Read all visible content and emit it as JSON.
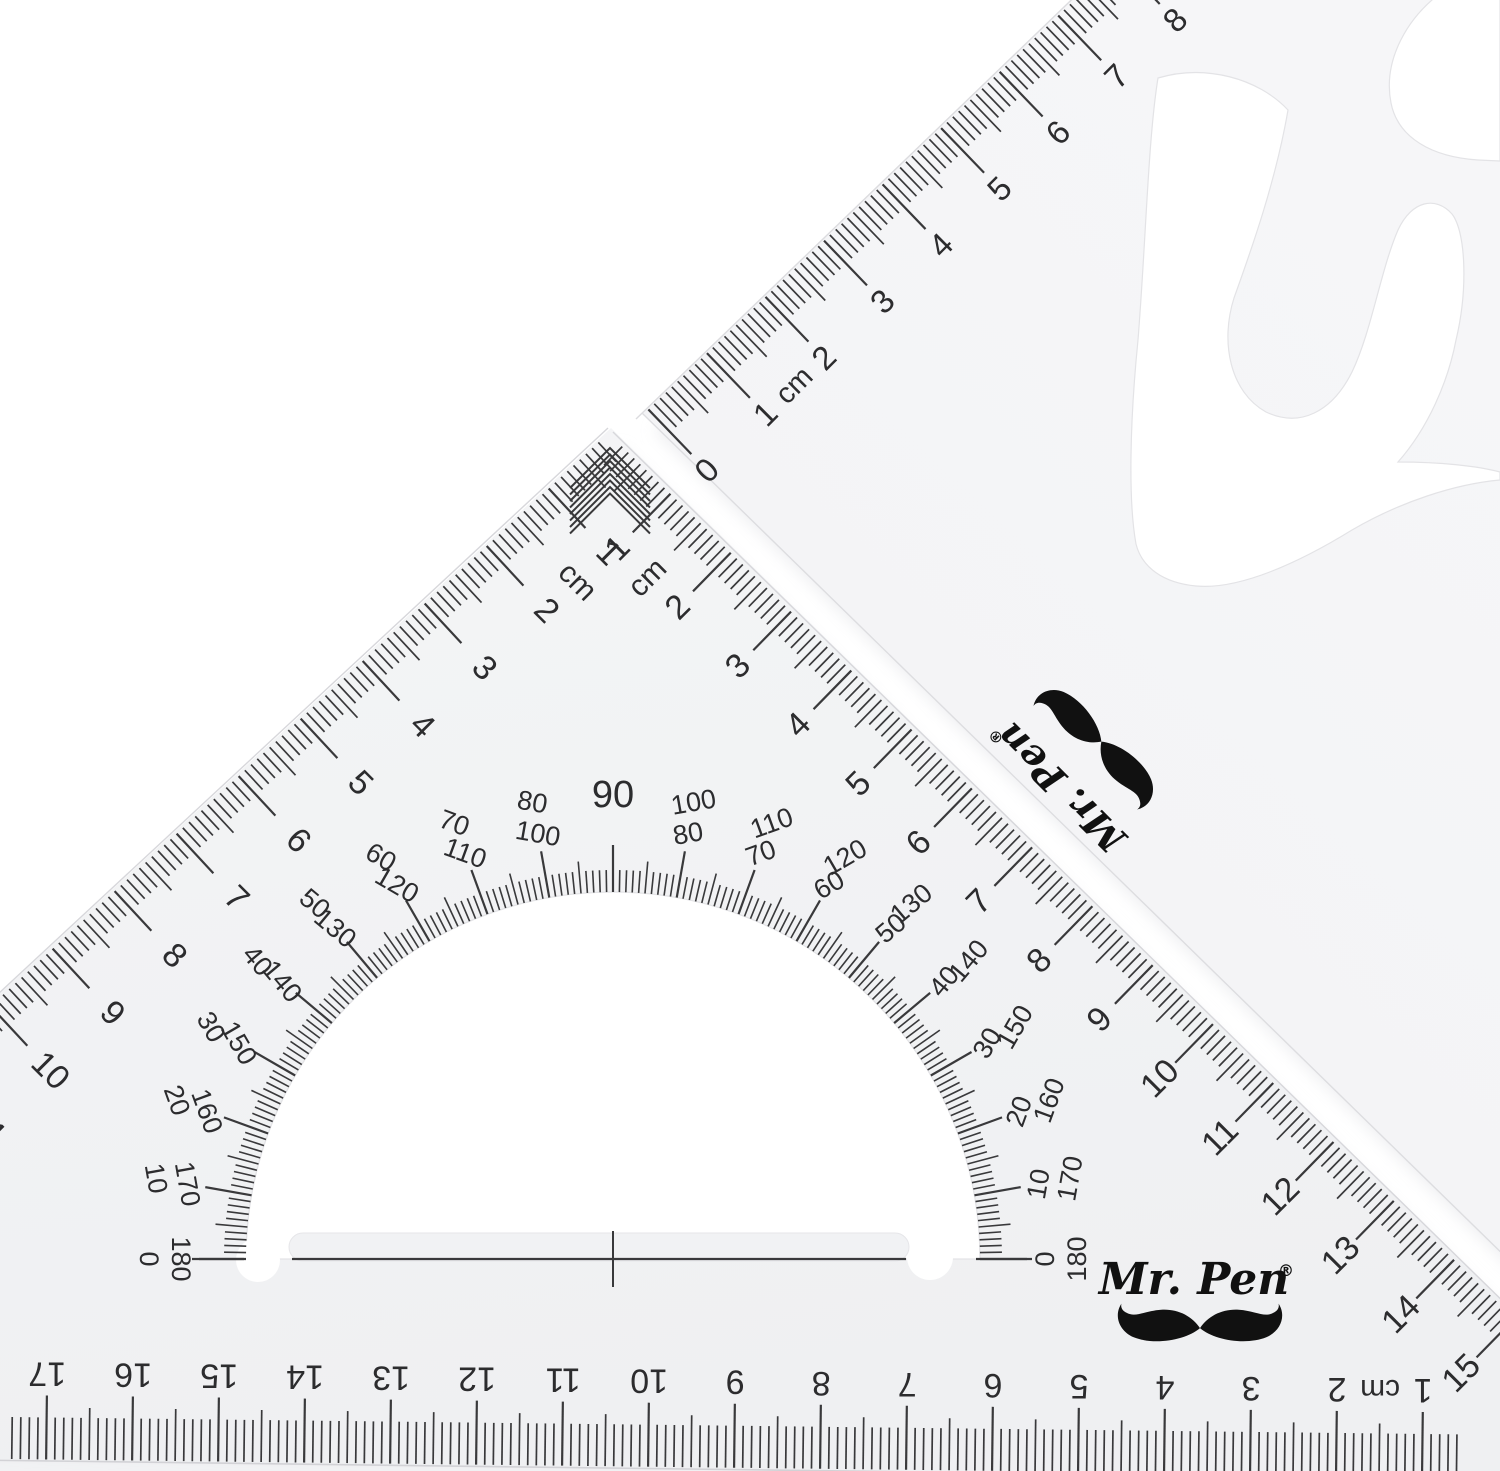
{
  "brand": {
    "name": "Mr. Pen",
    "registered": "®"
  },
  "colors": {
    "background": "#ffffff",
    "ink": "#2c2c2e",
    "tick": "#39393b",
    "logo_ink": "#111111",
    "material": "#f1f2f4",
    "material_upper": "#f4f5f7",
    "edge": "#d7d7db",
    "hole_edge": "#e3e3e6"
  },
  "protractor": {
    "min_deg": 0,
    "max_deg": 180,
    "tick_step": 1,
    "label_step": 10,
    "center_label": "90",
    "labels": [
      {
        "deg": 0,
        "outer": "0",
        "inner": "180"
      },
      {
        "deg": 10,
        "outer": "10",
        "inner": "170"
      },
      {
        "deg": 20,
        "outer": "20",
        "inner": "160"
      },
      {
        "deg": 30,
        "outer": "30",
        "inner": "150"
      },
      {
        "deg": 40,
        "outer": "40",
        "inner": "140"
      },
      {
        "deg": 50,
        "outer": "50",
        "inner": "130"
      },
      {
        "deg": 60,
        "outer": "60",
        "inner": "120"
      },
      {
        "deg": 70,
        "outer": "70",
        "inner": "110"
      },
      {
        "deg": 80,
        "outer": "80",
        "inner": "100"
      },
      {
        "deg": 90,
        "outer": "90",
        "inner": ""
      },
      {
        "deg": 100,
        "outer": "100",
        "inner": "80"
      },
      {
        "deg": 110,
        "outer": "110",
        "inner": "70"
      },
      {
        "deg": 120,
        "outer": "120",
        "inner": "60"
      },
      {
        "deg": 130,
        "outer": "130",
        "inner": "50"
      },
      {
        "deg": 140,
        "outer": "140",
        "inner": "40"
      },
      {
        "deg": 150,
        "outer": "150",
        "inner": "30"
      },
      {
        "deg": 160,
        "outer": "160",
        "inner": "20"
      },
      {
        "deg": 170,
        "outer": "170",
        "inner": "10"
      },
      {
        "deg": 180,
        "outer": "180",
        "inner": "0"
      }
    ]
  },
  "scales": {
    "big_left": {
      "unit": "cm",
      "labels": [
        {
          "t": "1",
          "p": 1
        },
        {
          "t": "cm",
          "p": 1.5
        },
        {
          "t": "2",
          "p": 2
        },
        {
          "t": "3",
          "p": 3
        },
        {
          "t": "4",
          "p": 4
        },
        {
          "t": "5",
          "p": 5
        },
        {
          "t": "6",
          "p": 6
        },
        {
          "t": "7",
          "p": 7
        },
        {
          "t": "8",
          "p": 8
        },
        {
          "t": "9",
          "p": 9
        },
        {
          "t": "10",
          "p": 10
        },
        {
          "t": "11",
          "p": 11
        }
      ]
    },
    "big_right": {
      "unit": "cm",
      "labels": [
        {
          "t": "1",
          "p": 1
        },
        {
          "t": "cm",
          "p": 1.5
        },
        {
          "t": "2",
          "p": 2
        },
        {
          "t": "3",
          "p": 3
        },
        {
          "t": "4",
          "p": 4
        },
        {
          "t": "5",
          "p": 5
        },
        {
          "t": "6",
          "p": 6
        },
        {
          "t": "7",
          "p": 7
        },
        {
          "t": "8",
          "p": 8
        },
        {
          "t": "9",
          "p": 9
        },
        {
          "t": "10",
          "p": 10
        },
        {
          "t": "11",
          "p": 11
        },
        {
          "t": "12",
          "p": 12
        },
        {
          "t": "13",
          "p": 13
        },
        {
          "t": "14",
          "p": 14
        },
        {
          "t": "15",
          "p": 15
        }
      ]
    },
    "upper_edge": {
      "unit": "cm",
      "labels": [
        {
          "t": "0",
          "p": 0
        },
        {
          "t": "1",
          "p": 1
        },
        {
          "t": "cm",
          "p": 1.5
        },
        {
          "t": "2",
          "p": 2
        },
        {
          "t": "3",
          "p": 3
        },
        {
          "t": "4",
          "p": 4
        },
        {
          "t": "5",
          "p": 5
        },
        {
          "t": "6",
          "p": 6
        },
        {
          "t": "7",
          "p": 7
        },
        {
          "t": "8",
          "p": 8
        }
      ]
    },
    "bottom": {
      "unit": "cm",
      "labels": [
        {
          "t": "1",
          "p": 1
        },
        {
          "t": "cm",
          "p": 1.5
        },
        {
          "t": "2",
          "p": 2
        },
        {
          "t": "3",
          "p": 3
        },
        {
          "t": "4",
          "p": 4
        },
        {
          "t": "5",
          "p": 5
        },
        {
          "t": "6",
          "p": 6
        },
        {
          "t": "7",
          "p": 7
        },
        {
          "t": "8",
          "p": 8
        },
        {
          "t": "9",
          "p": 9
        },
        {
          "t": "10",
          "p": 10
        },
        {
          "t": "11",
          "p": 11
        },
        {
          "t": "12",
          "p": 12
        },
        {
          "t": "13",
          "p": 13
        },
        {
          "t": "14",
          "p": 14
        },
        {
          "t": "15",
          "p": 15
        },
        {
          "t": "16",
          "p": 16
        },
        {
          "t": "17",
          "p": 17
        }
      ]
    }
  }
}
